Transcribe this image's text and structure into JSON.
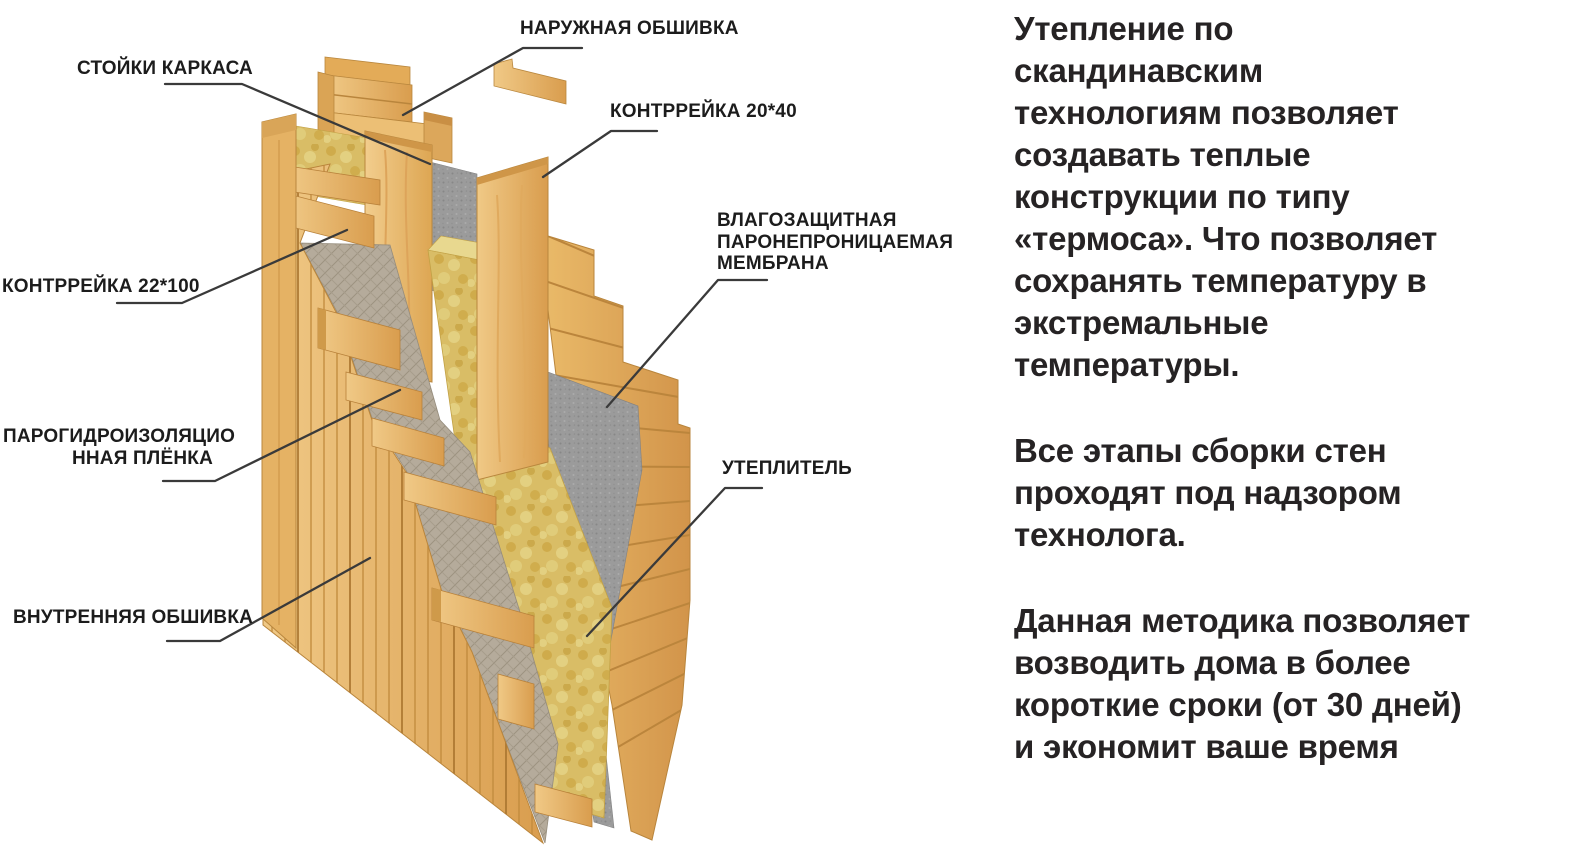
{
  "page": {
    "background": "#ffffff"
  },
  "diagram": {
    "labels": {
      "outer_cladding": "НАРУЖНАЯ ОБШИВКА",
      "frame_studs": "СТОЙКИ КАРКАСА",
      "counter_batten_small": "КОНТРРЕЙКА 20*40",
      "counter_batten_large": "КОНТРРЕЙКА 22*100",
      "membrane": "ВЛАГОЗАЩИТНАЯ\nПАРОНЕПРОНИЦАЕМАЯ\nМЕМБРАНА",
      "vapor_film": "ПАРОГИДРОИЗОЛЯЦИО\nННАЯ ПЛЁНКА",
      "insulation": "УТЕПЛИТЕЛЬ",
      "inner_cladding": "ВНУТРЕННЯЯ ОБШИВКА"
    },
    "colors": {
      "wood_light": "#eec27c",
      "wood_dark": "#d1924a",
      "insulation": "#d9bd66",
      "insulation_light": "#e8d88f",
      "membrane_gray": "#9b9b9b",
      "vapor_film_gray": "#b5ab9b",
      "leader_line": "#3a3a3a",
      "label_text": "#1c1c1c",
      "body_text": "#262324"
    }
  },
  "sidebar": {
    "paragraph_1": "Утепление по\nскандинавским\nтехнологиям позволяет\nсоздавать теплые\nконструкции по типу\n«термоса». Что позволяет\nсохранять температуру в\nэкстремальные\nтемпературы.",
    "paragraph_2": "Все этапы сборки стен\nпроходят под надзором\nтехнолога.",
    "paragraph_3": "Данная методика позволяет\nвозводить дома в более\nкороткие сроки (от 30 дней)\nи экономит ваше время"
  }
}
